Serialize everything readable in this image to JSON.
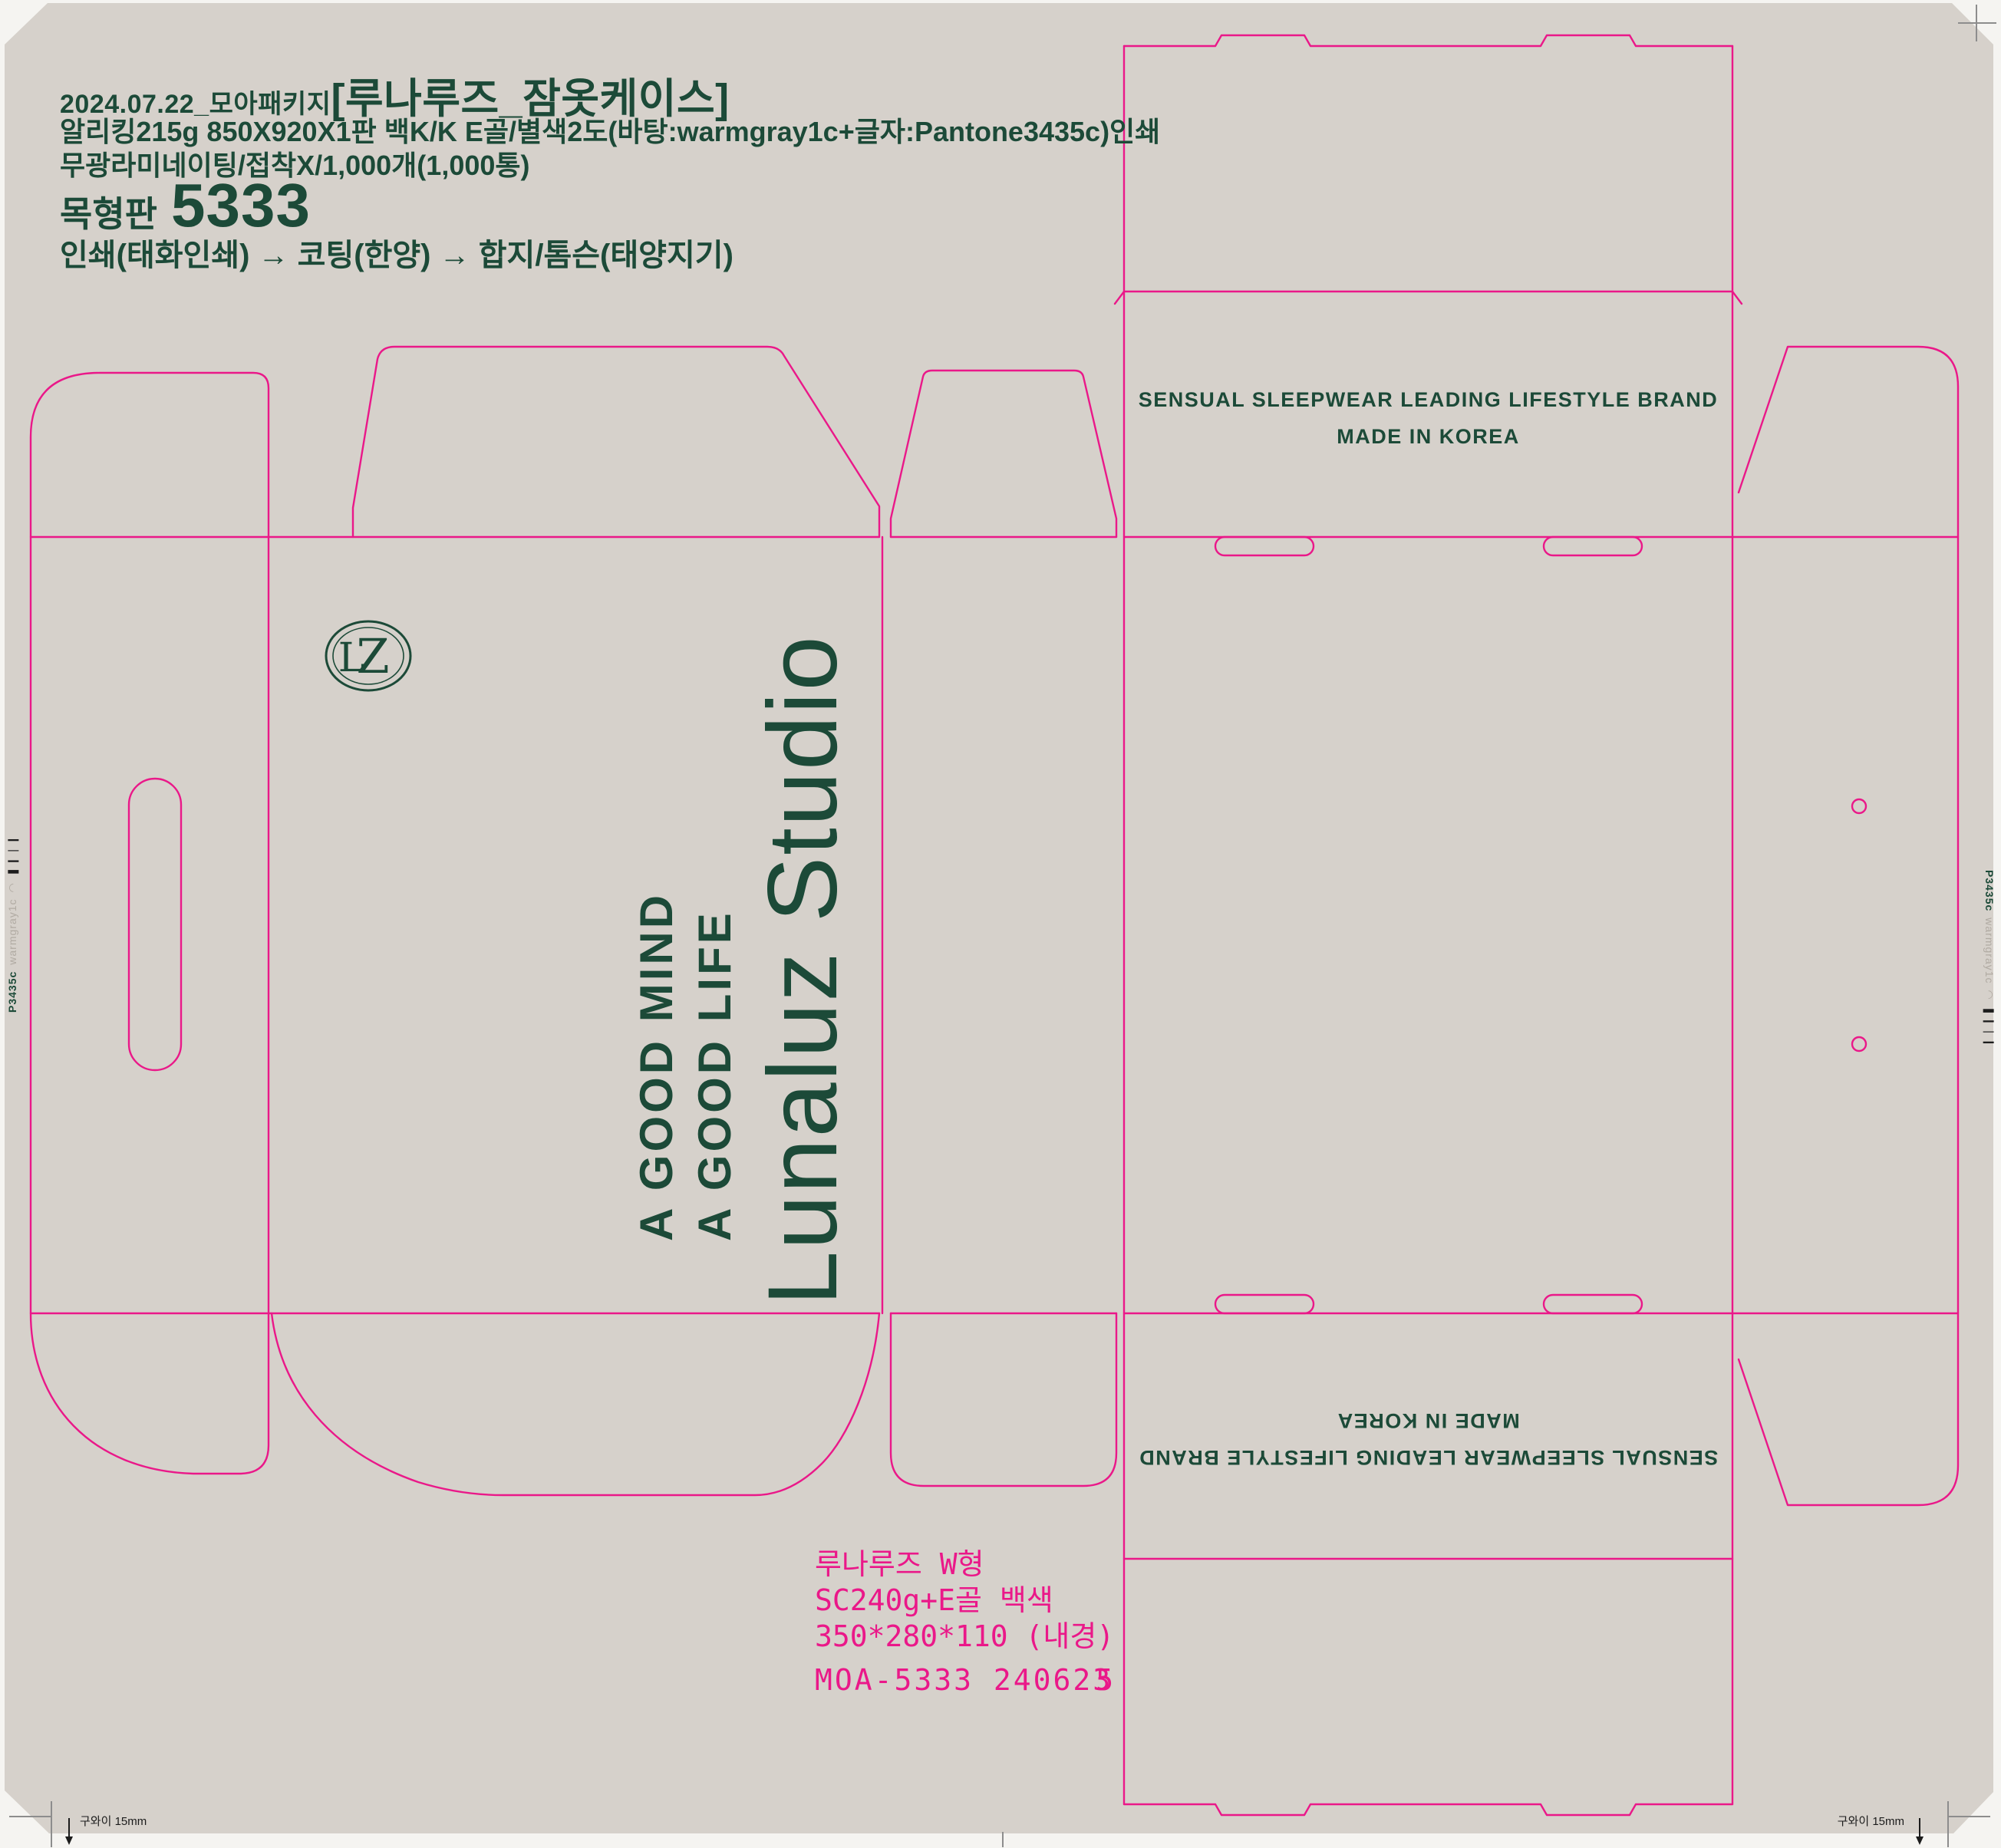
{
  "colors": {
    "bg": "#d6d1cb",
    "page": "#f5f4f1",
    "dieline": "#ea1889",
    "green": "#1c4a38",
    "swatch_gray": "#b1aba3",
    "mark": "#8d8d8d",
    "ink": "#1c1c1c"
  },
  "header": {
    "date_prefix": "2024.07.22_모아패키지",
    "title": "[루나루즈_잠옷케이스]",
    "spec_line1": "알리킹215g 850X920X1판 백K/K E골/별색2도(바탕:warmgray1c+글자:Pantone3435c)인쇄",
    "spec_line2": "무광라미네이팅/접착X/1,000개(1,000통)",
    "die_plate_label": "목형판",
    "die_plate_number": "5333",
    "process_flow": "인쇄(태화인쇄) → 코팅(한양) → 합지/톰슨(태양지기)"
  },
  "front_panel": {
    "tagline_line1": "A GOOD MIND",
    "tagline_line2": "A GOOD LIFE",
    "brand": "Lunaluz Studio",
    "logo_letter_l": "L",
    "logo_letter_z": "Z"
  },
  "top_panel": {
    "line1": "SENSUAL SLEEPWEAR LEADING LIFESTYLE BRAND",
    "line2": "MADE IN KOREA"
  },
  "spec_note": {
    "line1": "루나루즈  W형",
    "line2": "SC240g+E골  백색",
    "line3": "350*280*110 (내경)",
    "line4_prefix": "MOA-5333  24062",
    "line4_digit_under": "3",
    "line4_digit_over": "5"
  },
  "registration": {
    "pantone_swatch": "P3435c",
    "paper_swatch": "warmgray1c",
    "semicircle_mark": "◠",
    "colorbar_mark": "❚❙❘❙",
    "corner_note": "구와이 15mm",
    "arrow_down": "↓"
  }
}
